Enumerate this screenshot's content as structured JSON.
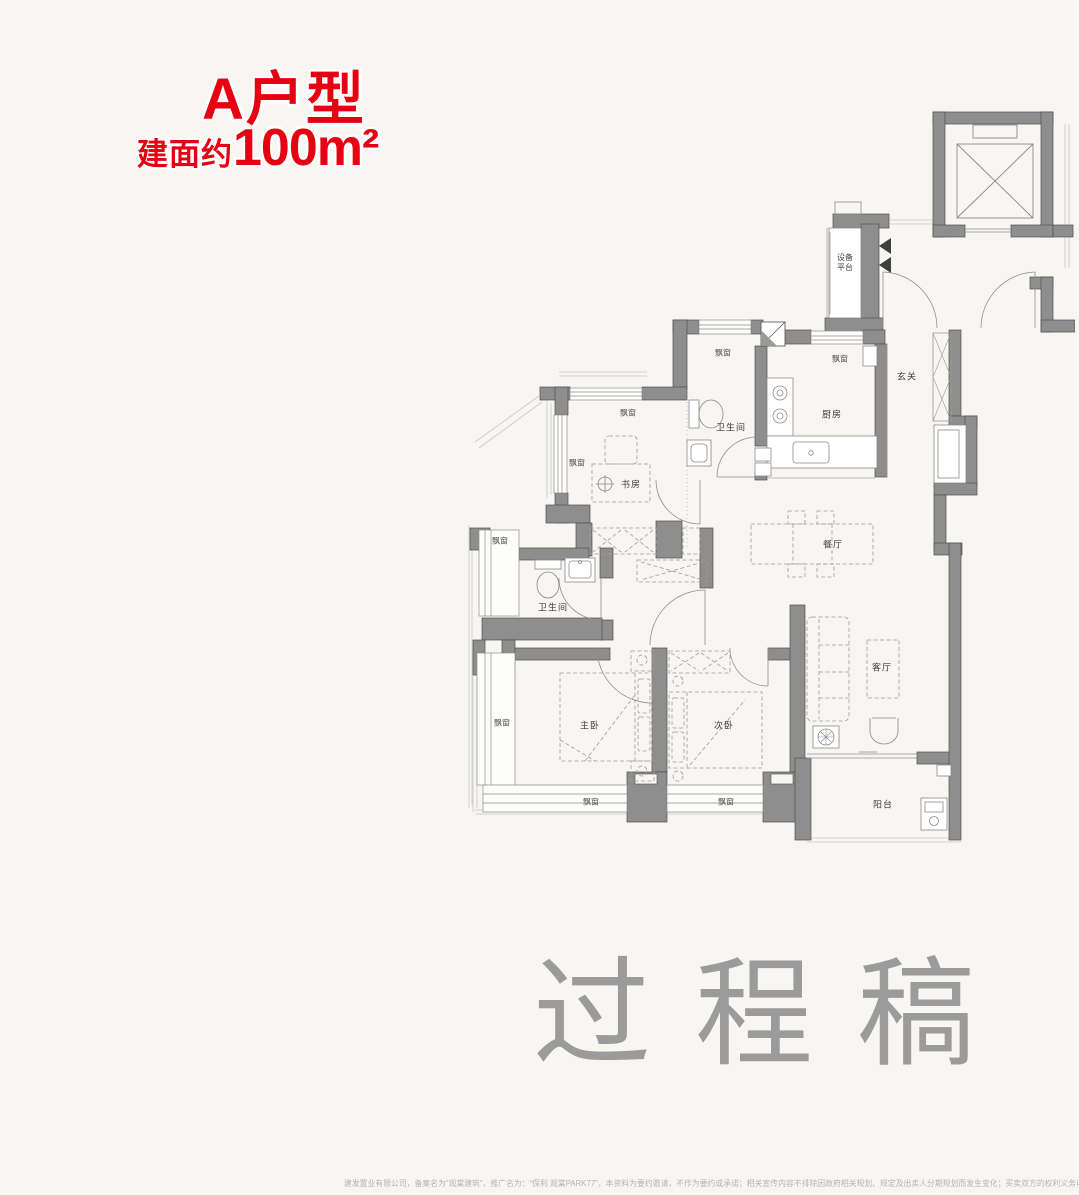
{
  "header": {
    "unit_name": "A户型",
    "area_prefix": "建面约",
    "area_value": "100m²"
  },
  "colors": {
    "accent_red": "#e60012",
    "wall_gray": "#8e8e8e",
    "watermark_gray": "#9b9b9b",
    "background": "#f7f6f3"
  },
  "rooms": {
    "equipment_platform_1": "设备",
    "equipment_platform_2": "平台",
    "entry": "玄关",
    "kitchen": "厨房",
    "bathroom": "卫生间",
    "study": "书房",
    "dining": "餐厅",
    "master_bedroom": "主卧",
    "second_bedroom": "次卧",
    "living": "客厅",
    "balcony": "阳台",
    "bay_window": "飘窗"
  },
  "watermark": "过程稿",
  "disclaimer": "建发置业有限公司，备案名为“观棠建筑”，推广名为：“保利 观棠PARK77”，本资料为要约邀请，不作为要约或承诺；相关宣传内容不排除因政府相关规划、规定及出卖人分期规划而发生变化；买卖双方的权利义务以双方签订的商品房买卖合同及附件等协议为准。"
}
